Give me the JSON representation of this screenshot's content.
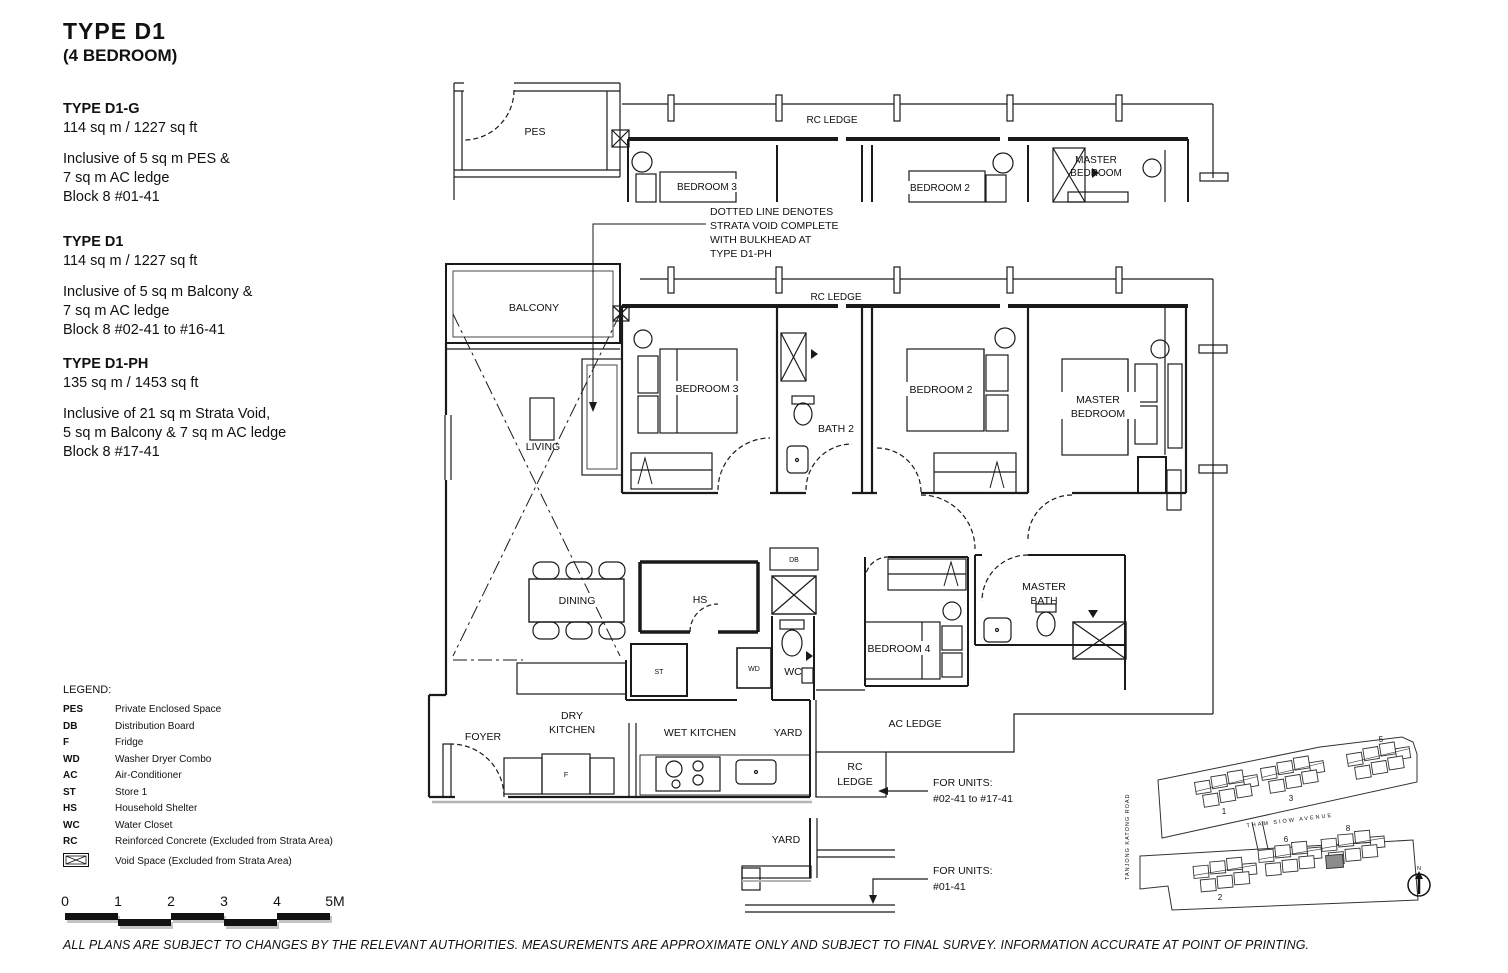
{
  "header": {
    "type_title": "TYPE  D1",
    "subtitle": "(4 BEDROOM)"
  },
  "specs": [
    {
      "name": "TYPE D1-G",
      "area": "114 sq m / 1227 sq ft",
      "desc1": "Inclusive of 5 sq m PES &",
      "desc2": "7 sq m AC ledge",
      "desc3": "Block 8  #01-41"
    },
    {
      "name": "TYPE D1",
      "area": "114 sq m / 1227 sq ft",
      "desc1": "Inclusive of 5 sq m Balcony &",
      "desc2": "7 sq m AC ledge",
      "desc3": "Block 8  #02-41 to #16-41"
    },
    {
      "name": "TYPE D1-PH",
      "area": "135 sq m / 1453 sq ft",
      "desc1": "Inclusive of 21 sq m Strata Void,",
      "desc2": "5 sq m Balcony & 7 sq m AC ledge",
      "desc3": "Block 8  #17-41"
    }
  ],
  "legend": {
    "title": "LEGEND:",
    "items": [
      {
        "abbr": "PES",
        "label": "Private Enclosed Space"
      },
      {
        "abbr": "DB",
        "label": "Distribution Board"
      },
      {
        "abbr": "F",
        "label": "Fridge"
      },
      {
        "abbr": "WD",
        "label": "Washer Dryer Combo"
      },
      {
        "abbr": "AC",
        "label": "Air-Conditioner"
      },
      {
        "abbr": "ST",
        "label": "Store 1"
      },
      {
        "abbr": "HS",
        "label": "Household Shelter"
      },
      {
        "abbr": "WC",
        "label": "Water Closet"
      },
      {
        "abbr": "RC",
        "label": "Reinforced Concrete (Excluded from Strata Area)"
      },
      {
        "abbr": "",
        "label": "Void Space (Excluded from Strata Area)"
      }
    ]
  },
  "scale": {
    "ticks": [
      "0",
      "1",
      "2",
      "3",
      "4",
      "5M"
    ]
  },
  "disclaimer": "ALL PLANS ARE SUBJECT TO CHANGES BY THE RELEVANT AUTHORITIES. MEASUREMENTS ARE APPROXIMATE ONLY AND SUBJECT TO FINAL SURVEY. INFORMATION ACCURATE AT POINT OF PRINTING.",
  "plan": {
    "labels": {
      "pes": "PES",
      "rc_ledge": "RC LEDGE",
      "balcony": "BALCONY",
      "living": "LIVING",
      "dining": "DINING",
      "bedroom3": "BEDROOM 3",
      "bedroom2": "BEDROOM 2",
      "master_line1": "MASTER",
      "master_line2": "BEDROOM",
      "bath2": "BATH 2",
      "hs": "HS",
      "db": "DB",
      "st": "ST",
      "wd": "WD",
      "wc": "WC",
      "f": "F",
      "bedroom4": "BEDROOM 4",
      "mbath_line1": "MASTER",
      "mbath_line2": "BATH",
      "foyer": "FOYER",
      "dry_line1": "DRY",
      "dry_line2": "KITCHEN",
      "wet_kitchen": "WET KITCHEN",
      "yard": "YARD",
      "ac_ledge": "AC LEDGE",
      "rc": "RC",
      "ledge": "LEDGE"
    },
    "annotation": [
      "DOTTED LINE DENOTES",
      "STRATA VOID COMPLETE",
      "WITH BULKHEAD AT",
      "TYPE D1-PH"
    ],
    "for_units_upper": [
      "FOR UNITS:",
      "#02-41 to #17-41"
    ],
    "for_units_lower": [
      "FOR UNITS:",
      "#01-41"
    ]
  },
  "site_plan": {
    "road_vertical": "TANJONG KATONG ROAD",
    "road_horizontal": "THAM  SIOW  AVENUE",
    "block_numbers_top": [
      "1",
      "3",
      "5"
    ],
    "block_numbers_bottom": [
      "2",
      "6",
      "8"
    ],
    "north_label": "N",
    "highlight_color": "#8c8c8c"
  }
}
